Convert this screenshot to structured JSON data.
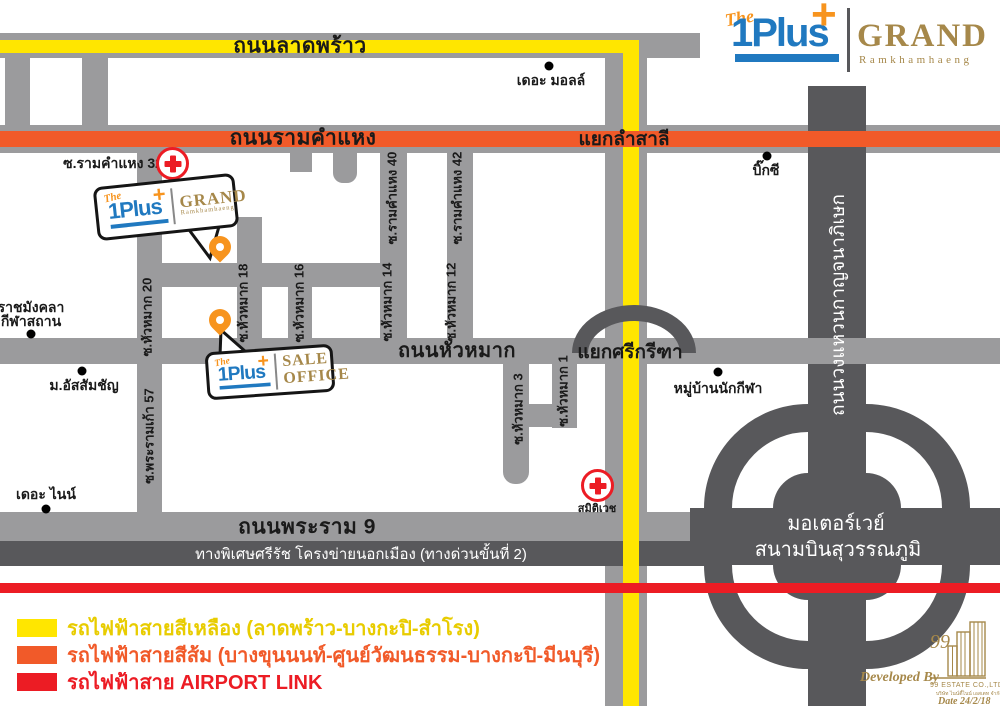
{
  "brand": {
    "the": "The",
    "name": "1Plus",
    "plus": "+",
    "grand": "GRAND",
    "grand_sub": "Ramkhamhaeng",
    "sale_line1": "SALE",
    "sale_line2": "OFFICE"
  },
  "roads": {
    "ladprao": "ถนนลาดพร้าว",
    "ramkhamhaeng": "ถนนรามคำแหง",
    "huamak": "ถนนหัวหมาก",
    "rama9": "ถนนพระราม 9",
    "expressway": "ทางพิเศษศรีรัช โครงข่ายนอกเมือง (ทางด่วนขั้นที่ 2)",
    "ring_road": "ถนนวงแหวนกาญจนาภิเษก",
    "motorway_line1": "มอเตอร์เวย์",
    "motorway_line2": "สนามบินสุวรรณภูมิ"
  },
  "intersections": {
    "lamsali": "แยกลำสาลี",
    "srikritha": "แยกศรีกรีฑา"
  },
  "sois": {
    "ram32": "ซ.รามคำแหง 32",
    "ram40": "ซ.รามคำแหง 40",
    "ram42": "ซ.รามคำแหง 42",
    "hm20": "ซ.หัวหมาก 20",
    "hm18": "ซ.หัวหมาก 18",
    "hm16": "ซ.หัวหมาก 16",
    "hm14": "ซ.หัวหมาก 14",
    "hm12": "ซ.หัวหมาก 12",
    "hm3": "ซ.หัวหมาก 3",
    "hm1": "ซ.หัวหมาก 1",
    "rama9_57": "ซ.พระรามเก้า 57"
  },
  "landmarks": {
    "the_mall": "เดอะ มอลล์",
    "big_c": "บิ๊กซี",
    "rajamangala_line1": "ราชมังคลา",
    "rajamangala_line2": "กีฬาสถาน",
    "assumption": "ม.อัสสัมชัญ",
    "the_nine": "เดอะ ไนน์",
    "athletes_village": "หมู่บ้านนักกีฬา",
    "hospital_ramkhamhaeng": "รามคำแหง",
    "hospital_samitivej": "สมิติเวช"
  },
  "legend": {
    "items": [
      {
        "label": "รถไฟฟ้าสายสีเหลือง (ลาดพร้าว-บางกะปิ-สำโรง)",
        "color": "#ffe600"
      },
      {
        "label": "รถไฟฟ้าสายสีส้ม (บางขุนนนท์-ศูนย์วัฒนธรรม-บางกะปิ-มีนบุรี)",
        "color": "#f15a29"
      },
      {
        "label": "รถไฟฟ้าสาย AIRPORT LINK",
        "color": "#ec1c24"
      }
    ]
  },
  "developer": {
    "prefix": "Developed By",
    "ninety_nine": "99",
    "company": "99 ESTATE CO.,LTD",
    "company_th": "บริษัท ไนน์ตี้ไนน์ เอสเตท จำกัด",
    "date": "Date 24/2/18"
  },
  "colors": {
    "road_gray": "#9b9b9d",
    "dark_gray": "#58585b",
    "mrt_yellow": "#ffe600",
    "mrt_orange": "#f15a29",
    "airport_link_red": "#ec1c24",
    "brand_blue": "#2079c0",
    "brand_orange": "#f7941e",
    "brand_gold": "#a6884a"
  }
}
